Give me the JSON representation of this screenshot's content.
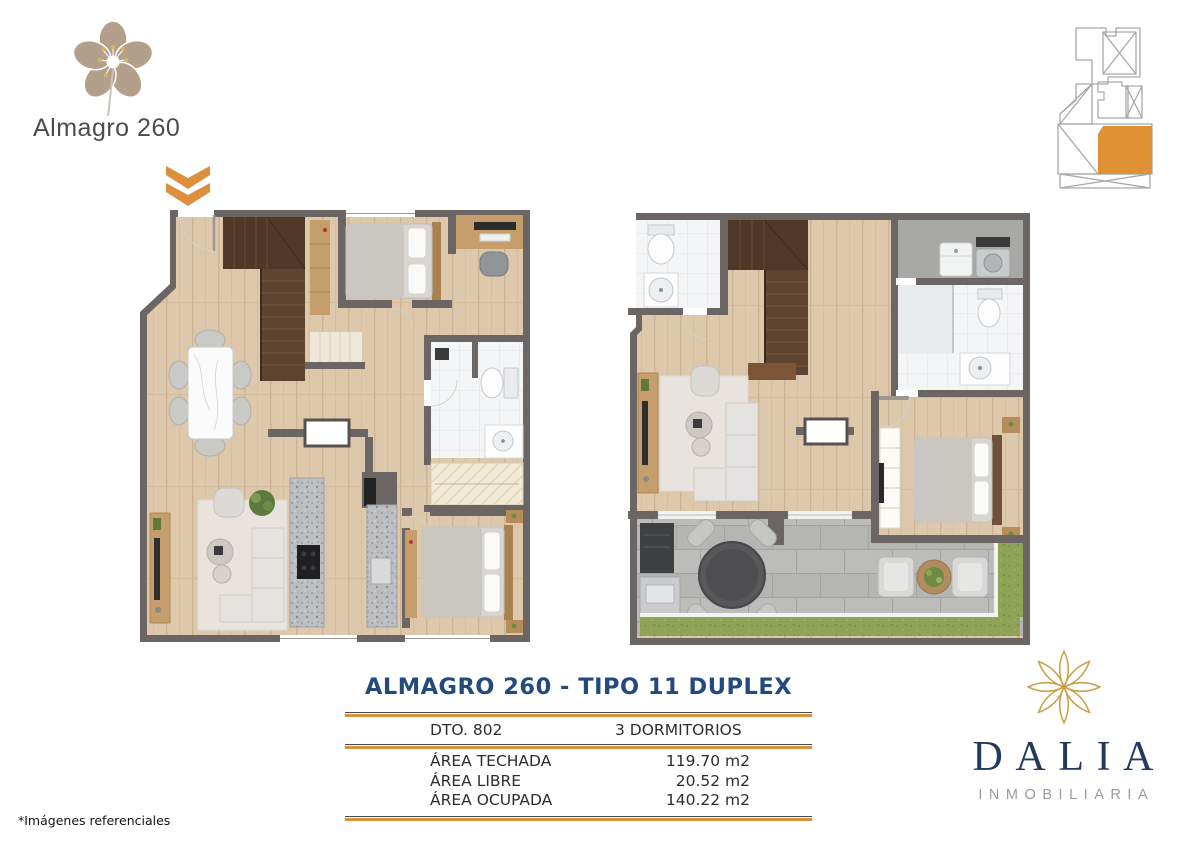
{
  "header": {
    "project_name": "Almagro 260"
  },
  "details": {
    "title": "ALMAGRO 260 - TIPO 11 DUPLEX",
    "unit_label": "DTO. 802",
    "bedrooms_label": "3 DORMITORIOS",
    "areas": [
      {
        "label": "ÁREA TECHADA",
        "value": "119.70 m2"
      },
      {
        "label": "ÁREA LIBRE",
        "value": "20.52 m2"
      },
      {
        "label": "ÁREA OCUPADA",
        "value": "140.22 m2"
      }
    ]
  },
  "developer": {
    "name": "DALIA",
    "tagline": "INMOBILIARIA"
  },
  "footnote": "*Imágenes referenciales",
  "icons": {
    "blossom_logo": "cherry-blossom-flower-logo",
    "down_chevrons": "double-chevron-down",
    "key_plan": "building-location-key-plan",
    "dalia_flower": "dahlia-flower-outline"
  },
  "colors": {
    "accent_orange": "#DE9038",
    "title_navy": "#224A7C",
    "logo_navy": "#223A5E",
    "logo_gold": "#C8A24B",
    "wall_gray": "#6B6663",
    "wood_floor": "#DDC8AB",
    "terrace_gray": "#BCBDBB",
    "grass_green": "#8EA355"
  }
}
